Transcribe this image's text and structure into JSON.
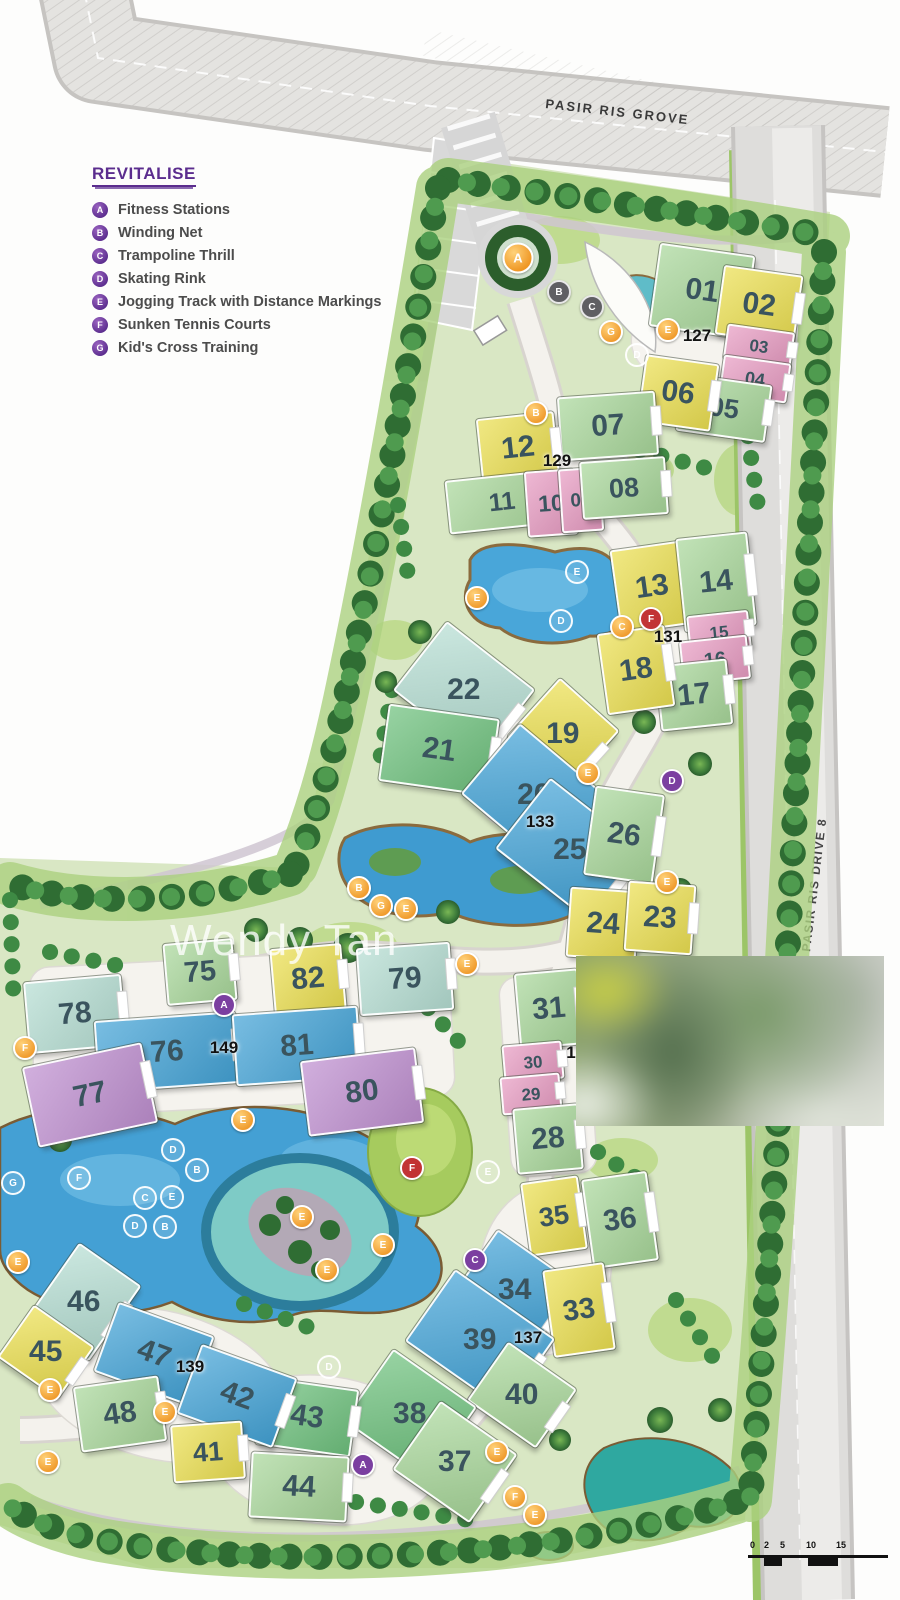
{
  "legend": {
    "title": "REVITALISE",
    "items": [
      {
        "letter": "A",
        "label": "Fitness Stations"
      },
      {
        "letter": "B",
        "label": "Winding Net"
      },
      {
        "letter": "C",
        "label": "Trampoline Thrill"
      },
      {
        "letter": "D",
        "label": "Skating Rink"
      },
      {
        "letter": "E",
        "label": "Jogging Track with Distance Markings"
      },
      {
        "letter": "F",
        "label": "Sunken Tennis Courts"
      },
      {
        "letter": "G",
        "label": "Kid's Cross Training"
      }
    ]
  },
  "roads": {
    "top_label": "PASIR RIS GROVE",
    "right_label": "PASIR RIS DRIVE 8"
  },
  "watermark": "Wendy Tan",
  "scale_bar": {
    "labels": [
      "0",
      "2",
      "5",
      "10",
      "15"
    ]
  },
  "palette": {
    "g": "#a9d79b",
    "t": "#b5ddd2",
    "G": "#6fc17e",
    "y": "#ebdf52",
    "p": "#e79cc2",
    "b": "#44a3d6",
    "v": "#bf90d0"
  },
  "block_labels": [
    {
      "n": "127",
      "x": 697,
      "y": 336
    },
    {
      "n": "129",
      "x": 557,
      "y": 461
    },
    {
      "n": "131",
      "x": 668,
      "y": 637
    },
    {
      "n": "133",
      "x": 540,
      "y": 822
    },
    {
      "n": "1",
      "x": 571,
      "y": 1053
    },
    {
      "n": "137",
      "x": 528,
      "y": 1338
    },
    {
      "n": "139",
      "x": 190,
      "y": 1367
    },
    {
      "n": "149",
      "x": 224,
      "y": 1048
    }
  ],
  "buildings": [
    {
      "n": "01",
      "x": 700,
      "y": 289,
      "w": 92,
      "h": 80,
      "r": 8,
      "c": "g"
    },
    {
      "n": "02",
      "x": 757,
      "y": 303,
      "w": 76,
      "h": 66,
      "r": 8,
      "c": "y"
    },
    {
      "n": "03",
      "x": 757,
      "y": 344,
      "w": 64,
      "h": 32,
      "r": 8,
      "c": "p"
    },
    {
      "n": "04",
      "x": 753,
      "y": 377,
      "w": 64,
      "h": 36,
      "r": 8,
      "c": "p"
    },
    {
      "n": "05",
      "x": 722,
      "y": 406,
      "w": 86,
      "h": 54,
      "r": 8,
      "c": "g"
    },
    {
      "n": "06",
      "x": 676,
      "y": 391,
      "w": 70,
      "h": 64,
      "r": 8,
      "c": "y"
    },
    {
      "n": "07",
      "x": 606,
      "y": 424,
      "w": 94,
      "h": 60,
      "r": -4,
      "c": "g"
    },
    {
      "n": "12",
      "x": 516,
      "y": 446,
      "w": 74,
      "h": 62,
      "r": -6,
      "c": "y"
    },
    {
      "n": "11",
      "x": 500,
      "y": 500,
      "w": 106,
      "h": 50,
      "r": -6,
      "c": "g"
    },
    {
      "n": "10",
      "x": 549,
      "y": 501,
      "w": 46,
      "h": 62,
      "r": -4,
      "c": "p"
    },
    {
      "n": "09",
      "x": 579,
      "y": 498,
      "w": 38,
      "h": 60,
      "r": -4,
      "c": "p"
    },
    {
      "n": "08",
      "x": 622,
      "y": 486,
      "w": 82,
      "h": 54,
      "r": -4,
      "c": "g"
    },
    {
      "n": "13",
      "x": 650,
      "y": 585,
      "w": 70,
      "h": 80,
      "r": -8,
      "c": "y"
    },
    {
      "n": "14",
      "x": 714,
      "y": 580,
      "w": 68,
      "h": 90,
      "r": -6,
      "c": "g"
    },
    {
      "n": "15",
      "x": 717,
      "y": 630,
      "w": 58,
      "h": 34,
      "r": -6,
      "c": "p"
    },
    {
      "n": "16",
      "x": 713,
      "y": 658,
      "w": 64,
      "h": 40,
      "r": -6,
      "c": "p"
    },
    {
      "n": "17",
      "x": 692,
      "y": 693,
      "w": 68,
      "h": 62,
      "r": -6,
      "c": "g"
    },
    {
      "n": "18",
      "x": 634,
      "y": 668,
      "w": 64,
      "h": 78,
      "r": -8,
      "c": "y"
    },
    {
      "n": "22",
      "x": 462,
      "y": 688,
      "w": 108,
      "h": 84,
      "r": 38,
      "c": "t"
    },
    {
      "n": "21",
      "x": 437,
      "y": 748,
      "w": 108,
      "h": 74,
      "r": 8,
      "c": "G"
    },
    {
      "n": "19",
      "x": 561,
      "y": 732,
      "w": 76,
      "h": 76,
      "r": 42,
      "c": "y"
    },
    {
      "n": "20",
      "x": 532,
      "y": 793,
      "w": 110,
      "h": 88,
      "r": 40,
      "c": "b"
    },
    {
      "n": "25",
      "x": 568,
      "y": 848,
      "w": 116,
      "h": 86,
      "r": 38,
      "c": "b"
    },
    {
      "n": "26",
      "x": 622,
      "y": 833,
      "w": 66,
      "h": 86,
      "r": 8,
      "c": "g"
    },
    {
      "n": "24",
      "x": 601,
      "y": 922,
      "w": 66,
      "h": 66,
      "r": 4,
      "c": "y"
    },
    {
      "n": "23",
      "x": 658,
      "y": 916,
      "w": 64,
      "h": 66,
      "r": 4,
      "c": "y"
    },
    {
      "n": "75",
      "x": 198,
      "y": 970,
      "w": 66,
      "h": 58,
      "r": -5,
      "c": "g"
    },
    {
      "n": "82",
      "x": 306,
      "y": 977,
      "w": 68,
      "h": 62,
      "r": -5,
      "c": "y"
    },
    {
      "n": "79",
      "x": 403,
      "y": 977,
      "w": 90,
      "h": 64,
      "r": -4,
      "c": "t"
    },
    {
      "n": "78",
      "x": 73,
      "y": 1012,
      "w": 94,
      "h": 68,
      "r": -5,
      "c": "t"
    },
    {
      "n": "76",
      "x": 165,
      "y": 1050,
      "w": 138,
      "h": 68,
      "r": -4,
      "c": "b"
    },
    {
      "n": "81",
      "x": 295,
      "y": 1044,
      "w": 122,
      "h": 68,
      "r": -4,
      "c": "b"
    },
    {
      "n": "77",
      "x": 88,
      "y": 1093,
      "w": 118,
      "h": 78,
      "r": -12,
      "c": "v"
    },
    {
      "n": "80",
      "x": 360,
      "y": 1090,
      "w": 112,
      "h": 72,
      "r": -7,
      "c": "v"
    },
    {
      "n": "31",
      "x": 547,
      "y": 1007,
      "w": 60,
      "h": 72,
      "r": -5,
      "c": "g"
    },
    {
      "n": "30",
      "x": 531,
      "y": 1060,
      "w": 56,
      "h": 34,
      "r": -5,
      "c": "p"
    },
    {
      "n": "29",
      "x": 529,
      "y": 1092,
      "w": 56,
      "h": 34,
      "r": -5,
      "c": "p"
    },
    {
      "n": "28",
      "x": 546,
      "y": 1137,
      "w": 62,
      "h": 62,
      "r": -5,
      "c": "g"
    },
    {
      "n": "35",
      "x": 552,
      "y": 1214,
      "w": 54,
      "h": 70,
      "r": -8,
      "c": "y"
    },
    {
      "n": "36",
      "x": 618,
      "y": 1218,
      "w": 62,
      "h": 86,
      "r": -8,
      "c": "g"
    },
    {
      "n": "34",
      "x": 513,
      "y": 1288,
      "w": 94,
      "h": 76,
      "r": 35,
      "c": "b"
    },
    {
      "n": "33",
      "x": 577,
      "y": 1308,
      "w": 58,
      "h": 84,
      "r": -8,
      "c": "y"
    },
    {
      "n": "39",
      "x": 478,
      "y": 1338,
      "w": 118,
      "h": 84,
      "r": 35,
      "c": "b"
    },
    {
      "n": "40",
      "x": 520,
      "y": 1393,
      "w": 80,
      "h": 68,
      "r": 35,
      "c": "g"
    },
    {
      "n": "38",
      "x": 408,
      "y": 1412,
      "w": 98,
      "h": 84,
      "r": 35,
      "c": "G"
    },
    {
      "n": "37",
      "x": 453,
      "y": 1460,
      "w": 90,
      "h": 80,
      "r": 35,
      "c": "g"
    },
    {
      "n": "43",
      "x": 305,
      "y": 1415,
      "w": 92,
      "h": 64,
      "r": 8,
      "c": "G"
    },
    {
      "n": "44",
      "x": 297,
      "y": 1485,
      "w": 94,
      "h": 62,
      "r": 3,
      "c": "g"
    },
    {
      "n": "46",
      "x": 82,
      "y": 1300,
      "w": 72,
      "h": 88,
      "r": 35,
      "c": "t"
    },
    {
      "n": "45",
      "x": 44,
      "y": 1350,
      "w": 70,
      "h": 60,
      "r": 35,
      "c": "y"
    },
    {
      "n": "47",
      "x": 152,
      "y": 1352,
      "w": 98,
      "h": 70,
      "r": 20,
      "c": "b"
    },
    {
      "n": "42",
      "x": 235,
      "y": 1394,
      "w": 98,
      "h": 70,
      "r": 20,
      "c": "b"
    },
    {
      "n": "48",
      "x": 118,
      "y": 1412,
      "w": 82,
      "h": 62,
      "r": -8,
      "c": "g"
    },
    {
      "n": "41",
      "x": 206,
      "y": 1450,
      "w": 68,
      "h": 54,
      "r": -4,
      "c": "y"
    }
  ],
  "pois": [
    {
      "l": "A",
      "t": "O",
      "x": 518,
      "y": 258
    },
    {
      "l": "B",
      "t": "s",
      "x": 559,
      "y": 292
    },
    {
      "l": "C",
      "t": "s",
      "x": 592,
      "y": 307
    },
    {
      "l": "G",
      "t": "o",
      "x": 611,
      "y": 332
    },
    {
      "l": "E",
      "t": "o",
      "x": 668,
      "y": 330
    },
    {
      "l": "B",
      "t": "o",
      "x": 536,
      "y": 413
    },
    {
      "l": "E",
      "t": "o",
      "x": 477,
      "y": 598
    },
    {
      "l": "C",
      "t": "o",
      "x": 622,
      "y": 627
    },
    {
      "l": "F",
      "t": "r",
      "x": 651,
      "y": 619
    },
    {
      "l": "E",
      "t": "w",
      "x": 577,
      "y": 572
    },
    {
      "l": "D",
      "t": "w",
      "x": 561,
      "y": 621
    },
    {
      "l": "D",
      "t": "w",
      "x": 637,
      "y": 355
    },
    {
      "l": "E",
      "t": "o",
      "x": 588,
      "y": 773
    },
    {
      "l": "D",
      "t": "u",
      "x": 672,
      "y": 781
    },
    {
      "l": "E",
      "t": "o",
      "x": 667,
      "y": 882
    },
    {
      "l": "B",
      "t": "o",
      "x": 359,
      "y": 888
    },
    {
      "l": "G",
      "t": "o",
      "x": 381,
      "y": 906
    },
    {
      "l": "E",
      "t": "o",
      "x": 406,
      "y": 909
    },
    {
      "l": "E",
      "t": "o",
      "x": 467,
      "y": 964
    },
    {
      "l": "A",
      "t": "u",
      "x": 224,
      "y": 1005
    },
    {
      "l": "F",
      "t": "o",
      "x": 25,
      "y": 1048
    },
    {
      "l": "E",
      "t": "o",
      "x": 243,
      "y": 1120
    },
    {
      "l": "F",
      "t": "r",
      "x": 412,
      "y": 1168
    },
    {
      "l": "D",
      "t": "w",
      "x": 173,
      "y": 1150
    },
    {
      "l": "B",
      "t": "w",
      "x": 197,
      "y": 1170
    },
    {
      "l": "F",
      "t": "w",
      "x": 79,
      "y": 1178
    },
    {
      "l": "G",
      "t": "w",
      "x": 13,
      "y": 1183
    },
    {
      "l": "C",
      "t": "w",
      "x": 145,
      "y": 1198
    },
    {
      "l": "E",
      "t": "w",
      "x": 172,
      "y": 1197
    },
    {
      "l": "D",
      "t": "w",
      "x": 135,
      "y": 1226
    },
    {
      "l": "B",
      "t": "w",
      "x": 165,
      "y": 1227
    },
    {
      "l": "E",
      "t": "w",
      "x": 488,
      "y": 1172
    },
    {
      "l": "E",
      "t": "o",
      "x": 302,
      "y": 1217
    },
    {
      "l": "E",
      "t": "o",
      "x": 383,
      "y": 1245
    },
    {
      "l": "E",
      "t": "o",
      "x": 327,
      "y": 1270
    },
    {
      "l": "E",
      "t": "o",
      "x": 18,
      "y": 1262
    },
    {
      "l": "C",
      "t": "u",
      "x": 475,
      "y": 1260
    },
    {
      "l": "D",
      "t": "w",
      "x": 329,
      "y": 1367
    },
    {
      "l": "A",
      "t": "u",
      "x": 363,
      "y": 1465
    },
    {
      "l": "E",
      "t": "o",
      "x": 50,
      "y": 1390
    },
    {
      "l": "E",
      "t": "o",
      "x": 165,
      "y": 1412
    },
    {
      "l": "E",
      "t": "o",
      "x": 48,
      "y": 1462
    },
    {
      "l": "E",
      "t": "o",
      "x": 497,
      "y": 1452
    },
    {
      "l": "F",
      "t": "o",
      "x": 515,
      "y": 1497
    },
    {
      "l": "E",
      "t": "o",
      "x": 535,
      "y": 1515
    }
  ]
}
